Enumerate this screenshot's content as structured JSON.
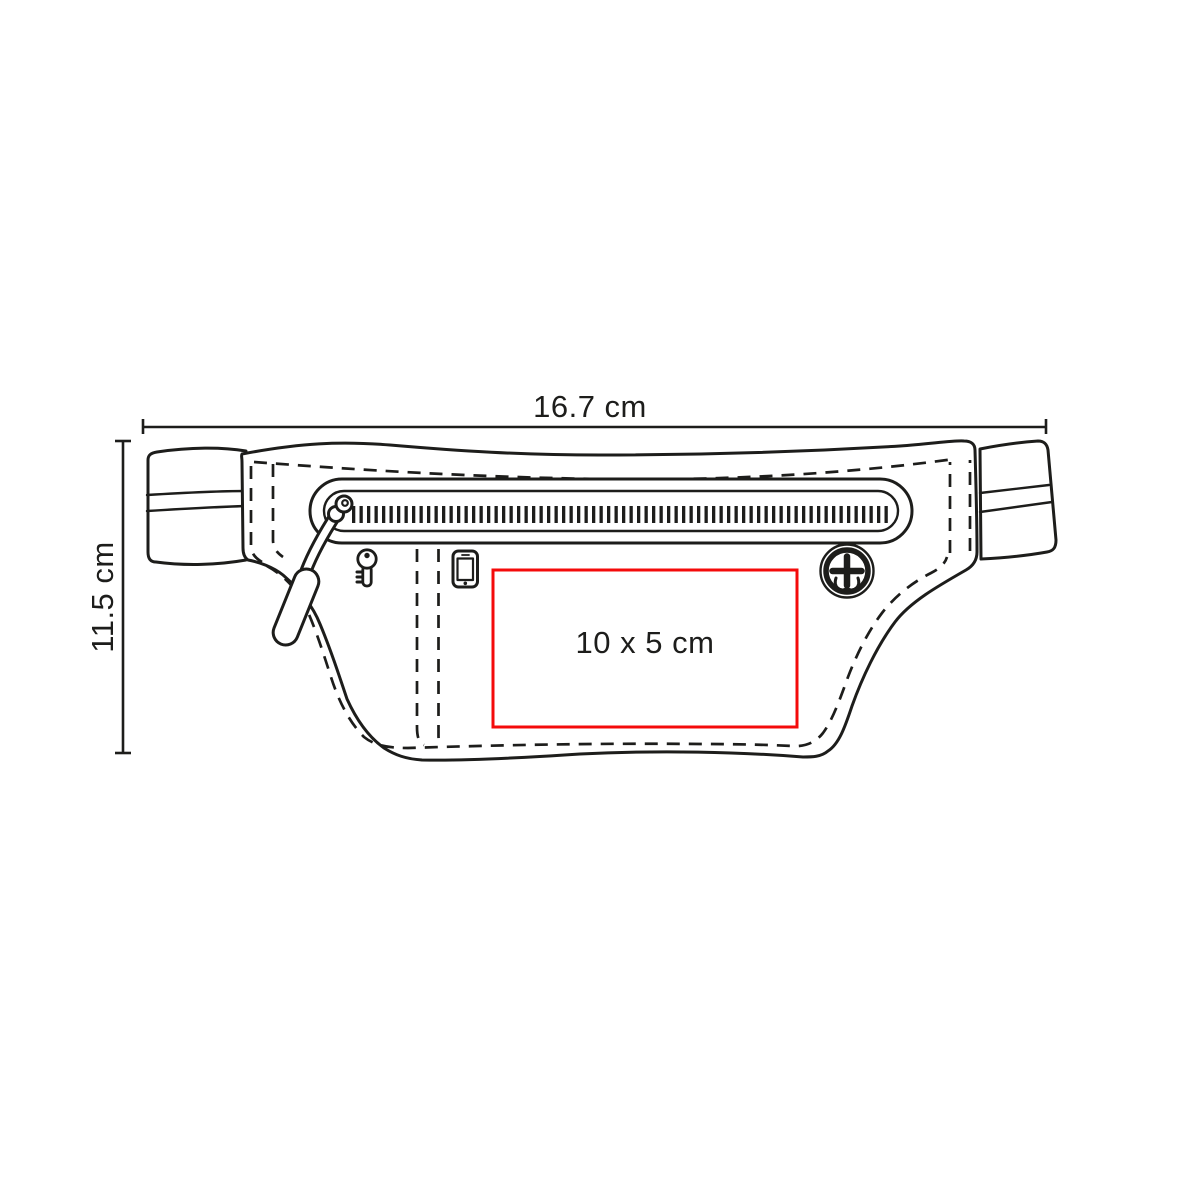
{
  "diagram": {
    "kind": "product-dimension-drawing",
    "subject": "waist-bag-line-drawing",
    "width_dimension": {
      "label": "16.7 cm"
    },
    "height_dimension": {
      "label": "11.5 cm"
    },
    "print_area": {
      "label": "10 x 5 cm",
      "border_color": "#f40b0b"
    },
    "colors": {
      "background": "#ffffff",
      "line": "#1d1d1b",
      "accent_red": "#f40b0b"
    },
    "icons": [
      "key-icon",
      "smartphone-icon",
      "audio-port-icon",
      "zipper-teeth",
      "zipper-slider",
      "zipper-pull-tab"
    ]
  }
}
